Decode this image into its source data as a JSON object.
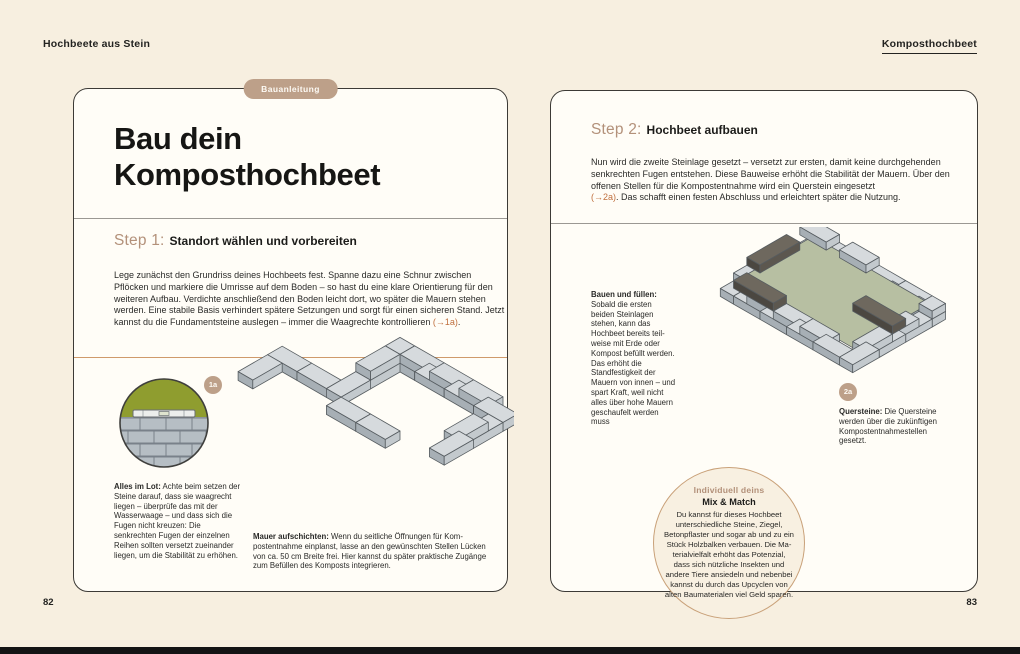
{
  "header": {
    "left": "Hochbeete aus Stein",
    "right": "Komposthochbeet"
  },
  "left_page": {
    "tag": "Bauanleitung",
    "title_line1": "Bau dein",
    "title_line2": "Komposthochbeet",
    "step1": {
      "label": "Step 1:",
      "heading": "Standort wählen und vorbereiten",
      "body": "Lege zunächst den Grundriss deines Hochbeets fest. Spanne dazu eine Schnur zwischen Pflöcken und markiere die Umrisse auf dem Boden – so hast du eine klare Orientierung für den weiteren Aufbau. Verdichte anschließend den Boden leicht dort, wo später die Mauern stehen werden. Eine stabile Basis verhindert spätere Setzungen und sorgt für einen sicheren Stand. Jetzt kannst du die Fundamentsteine auslegen – immer die Waagrechte kontrollieren ",
      "link": "(→1a)",
      "body_after": "."
    },
    "figure_badge": "1a",
    "caption_lot": {
      "bold": "Alles im Lot:",
      "text": " Achte beim setzen der Steine darauf, dass sie waagrecht liegen – überprüfe das mit der Wasserwaage – und dass sich die Fugen nicht kreuzen: Die senkrechten Fugen der einzelnen Reihen sollten versetzt zueinander liegen, um die Stabilität zu erhöhen."
    },
    "caption_mauer": {
      "bold": "Mauer aufschichten:",
      "text": " Wenn du seitliche Öffnungen für Kom­postentnahme einplanst, lasse an den gewünschten Stellen Lücken von ca. 50 cm Breite frei. Hier kannst du später prak­tische Zugänge zum Befüllen des Komposts integrieren."
    },
    "page_number": "82"
  },
  "right_page": {
    "step2": {
      "label": "Step 2:",
      "heading": "Hochbeet aufbauen",
      "body": "Nun wird die zweite Steinlage gesetzt – versetzt zur ersten, damit keine durchgehenden senk­rechten Fugen entstehen. Diese Bauweise erhöht die Stabilität der Mauern. Über den offenen Stellen für die Kompostentnahme wird ein Querstein eingesetzt",
      "link": "(→2a)",
      "body_after": ". Das schafft einen festen Abschluss und erleichtert später die Nutzung."
    },
    "caption_bauen": {
      "bold": "Bauen und füllen:",
      "text": " Sobald die ersten beiden Steinlagen stehen, kann das Hochbeet bereits teil­weise mit Erde oder Kompost befüllt wer­den. Das erhöht die Standfestigkeit der Mauern von innen – und spart Kraft, weil nicht alles über hohe Mauern geschaufelt werden muss"
    },
    "figure_badge": "2a",
    "caption_quersteine": {
      "bold": "Quersteine:",
      "text": " Die Quersteine werden über die zukünftigen Kompostentnahme­stellen gesetzt."
    },
    "circle": {
      "eyebrow": "Individuell deins",
      "title": "Mix & Match",
      "text": "Du kannst für dieses Hochbeet unterschiedliche Steine, Ziegel, Betonpflaster und sogar ab und zu ein Stück Holzbalken verbauen. Die Ma­terialvielfalt erhöht das Potenzial, dass sich nützliche Insekten und andere Tiere an­siedeln und nebenbei kannst du durch das Upcyclen von alten Baumaterialen viel Geld sparen."
    },
    "page_number": "83"
  },
  "colors": {
    "page_background": "#f7efe0",
    "card_background": "#fffdf7",
    "card_border": "#3c3a36",
    "accent_tan": "#bda089",
    "step_label": "#b3917a",
    "link_orange": "#c0703f",
    "rule_tan": "#cf9a6b",
    "rule_gray": "#9b9893",
    "stone_gray": "#c3c9cd",
    "bed_green": "#b7bfa2",
    "grass_olive": "#8f9d2f",
    "beam_dark": "#5c574f",
    "bottom_bar": "#141414"
  }
}
